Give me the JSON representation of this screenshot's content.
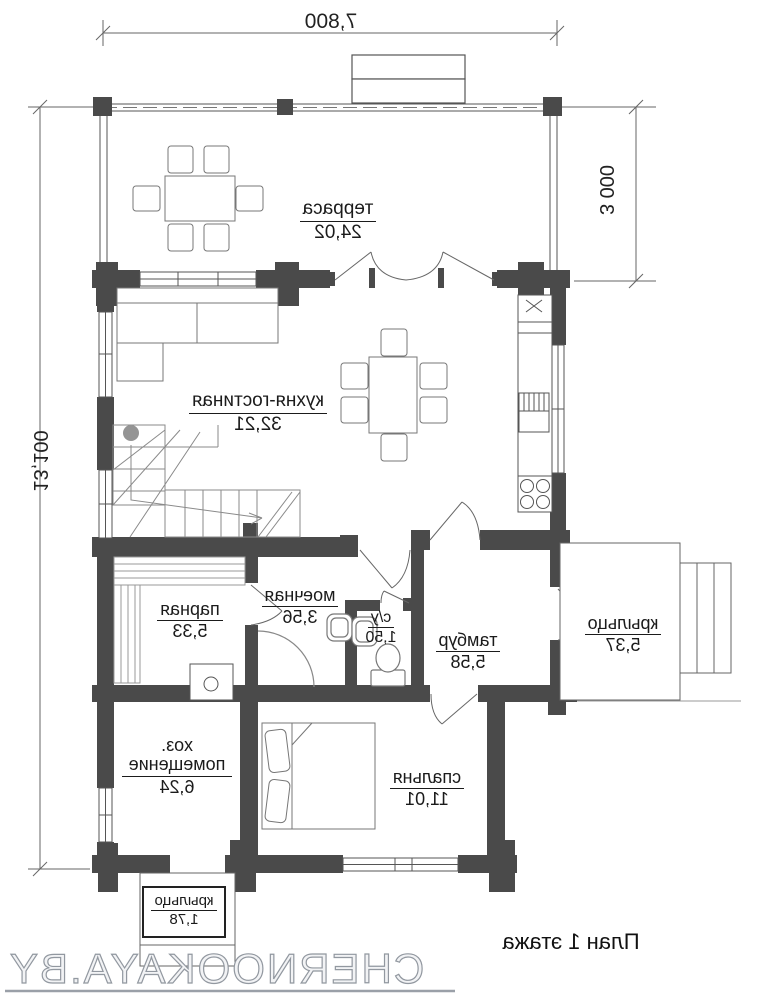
{
  "dimensions": {
    "width_top": "7,800",
    "height_left": "13,100",
    "terrace_depth": "3 000"
  },
  "rooms": {
    "terrace": {
      "name": "терраса",
      "area": "24,02"
    },
    "kitchen_living": {
      "name": "кухня-гостиная",
      "area": "32,21"
    },
    "steam_room": {
      "name": "парная",
      "area": "5,33"
    },
    "wash_room": {
      "name": "моечная",
      "area": "3,56"
    },
    "wc": {
      "name": "с/у",
      "area": "1,50"
    },
    "vestibule": {
      "name": "тамбур",
      "area": "5,58"
    },
    "porch_right": {
      "name": "крыльцо",
      "area": "5,37"
    },
    "utility": {
      "name": "хоз. помещение",
      "area": "6,24"
    },
    "bedroom": {
      "name": "спальня",
      "area": "11,01"
    },
    "porch_bottom": {
      "name": "крыльцо",
      "area": "1,78"
    }
  },
  "plan_title": "План 1 этажа",
  "watermark": "CHERNOOKAYA.BY",
  "colors": {
    "wall": "#4a4a4a",
    "line": "#555555",
    "watermark_stroke": "#9298a0"
  }
}
